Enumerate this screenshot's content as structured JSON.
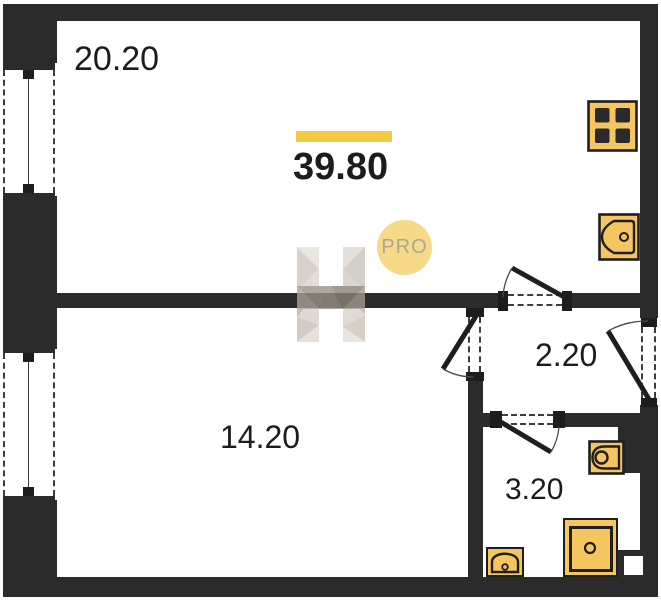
{
  "plan": {
    "total_area": "39.80",
    "rooms": [
      {
        "name": "living-room",
        "area": "20.20"
      },
      {
        "name": "bedroom",
        "area": "14.20"
      },
      {
        "name": "hallway",
        "area": "2.20"
      },
      {
        "name": "bathroom",
        "area": "3.20"
      }
    ],
    "watermark": {
      "icon": "h-logo",
      "badge": "PRO"
    },
    "fixtures": [
      "stove-icon",
      "kitchen-sink-icon",
      "toilet-icon",
      "washing-machine-icon",
      "bath-sink-icon"
    ]
  },
  "colors": {
    "wall": "#2b2b2b",
    "accent_yellow": "#f7c843",
    "fixture_fill": "#f5c660",
    "pro_badge_fill": "#f7da87",
    "pro_badge_text": "#ada593",
    "label_text": "#1c1c1c"
  }
}
